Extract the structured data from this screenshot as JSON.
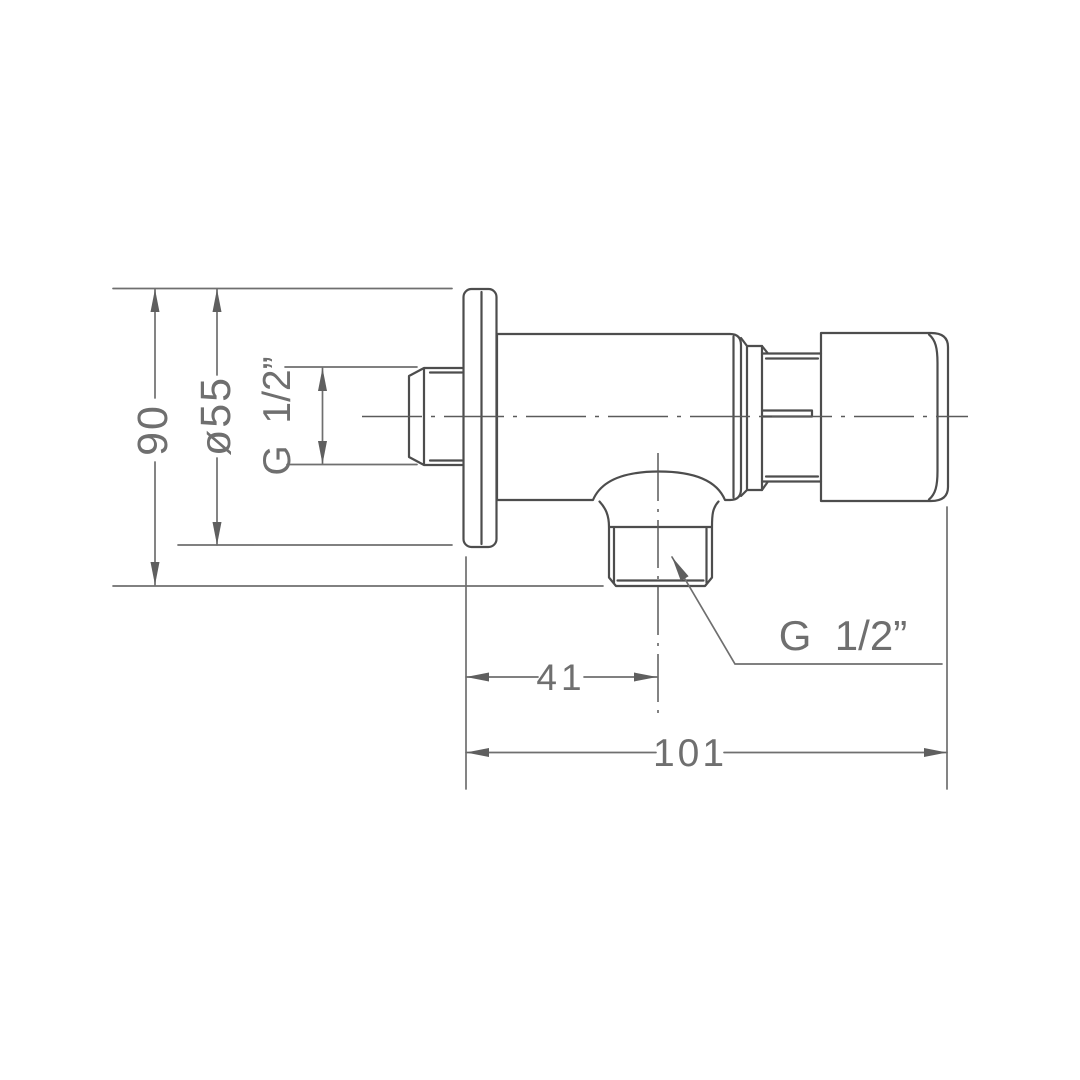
{
  "drawing": {
    "background_color": "#ffffff",
    "outline_color": "#4d4d4d",
    "dimension_color": "#6f6f6f",
    "labels": {
      "overall_height": "90",
      "flange_diameter": "ø55",
      "inlet_thread": "G  1/2”",
      "outlet_offset": "41",
      "overall_length": "101",
      "outlet_thread": "G  1/2”"
    }
  }
}
